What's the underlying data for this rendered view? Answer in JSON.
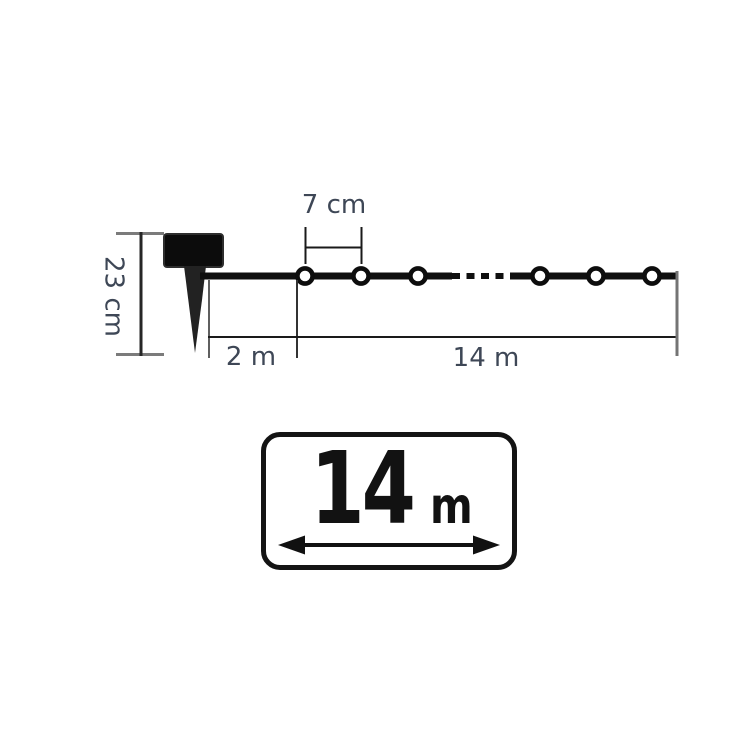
{
  "diagram": {
    "labels": {
      "bulb_spacing": "7 cm",
      "stake_height": "23 cm",
      "lead_length": "2 m",
      "string_length": "14 m"
    },
    "visible_bulb_count": 6,
    "icons": {
      "solar_panel": "solar-panel-icon",
      "ground_spike": "ground-spike-icon",
      "bulb": "light-bulb-icon",
      "double_arrow": "double-arrow-icon"
    }
  },
  "badge": {
    "value": "14",
    "unit": "m"
  },
  "colors": {
    "line": "#1a1a1a",
    "wire": "#0f0f0f",
    "gray_line": "#747474",
    "dim_text": "#3e4756",
    "badge_border": "#141414",
    "badge_text": "#121212",
    "background": "#ffffff"
  }
}
